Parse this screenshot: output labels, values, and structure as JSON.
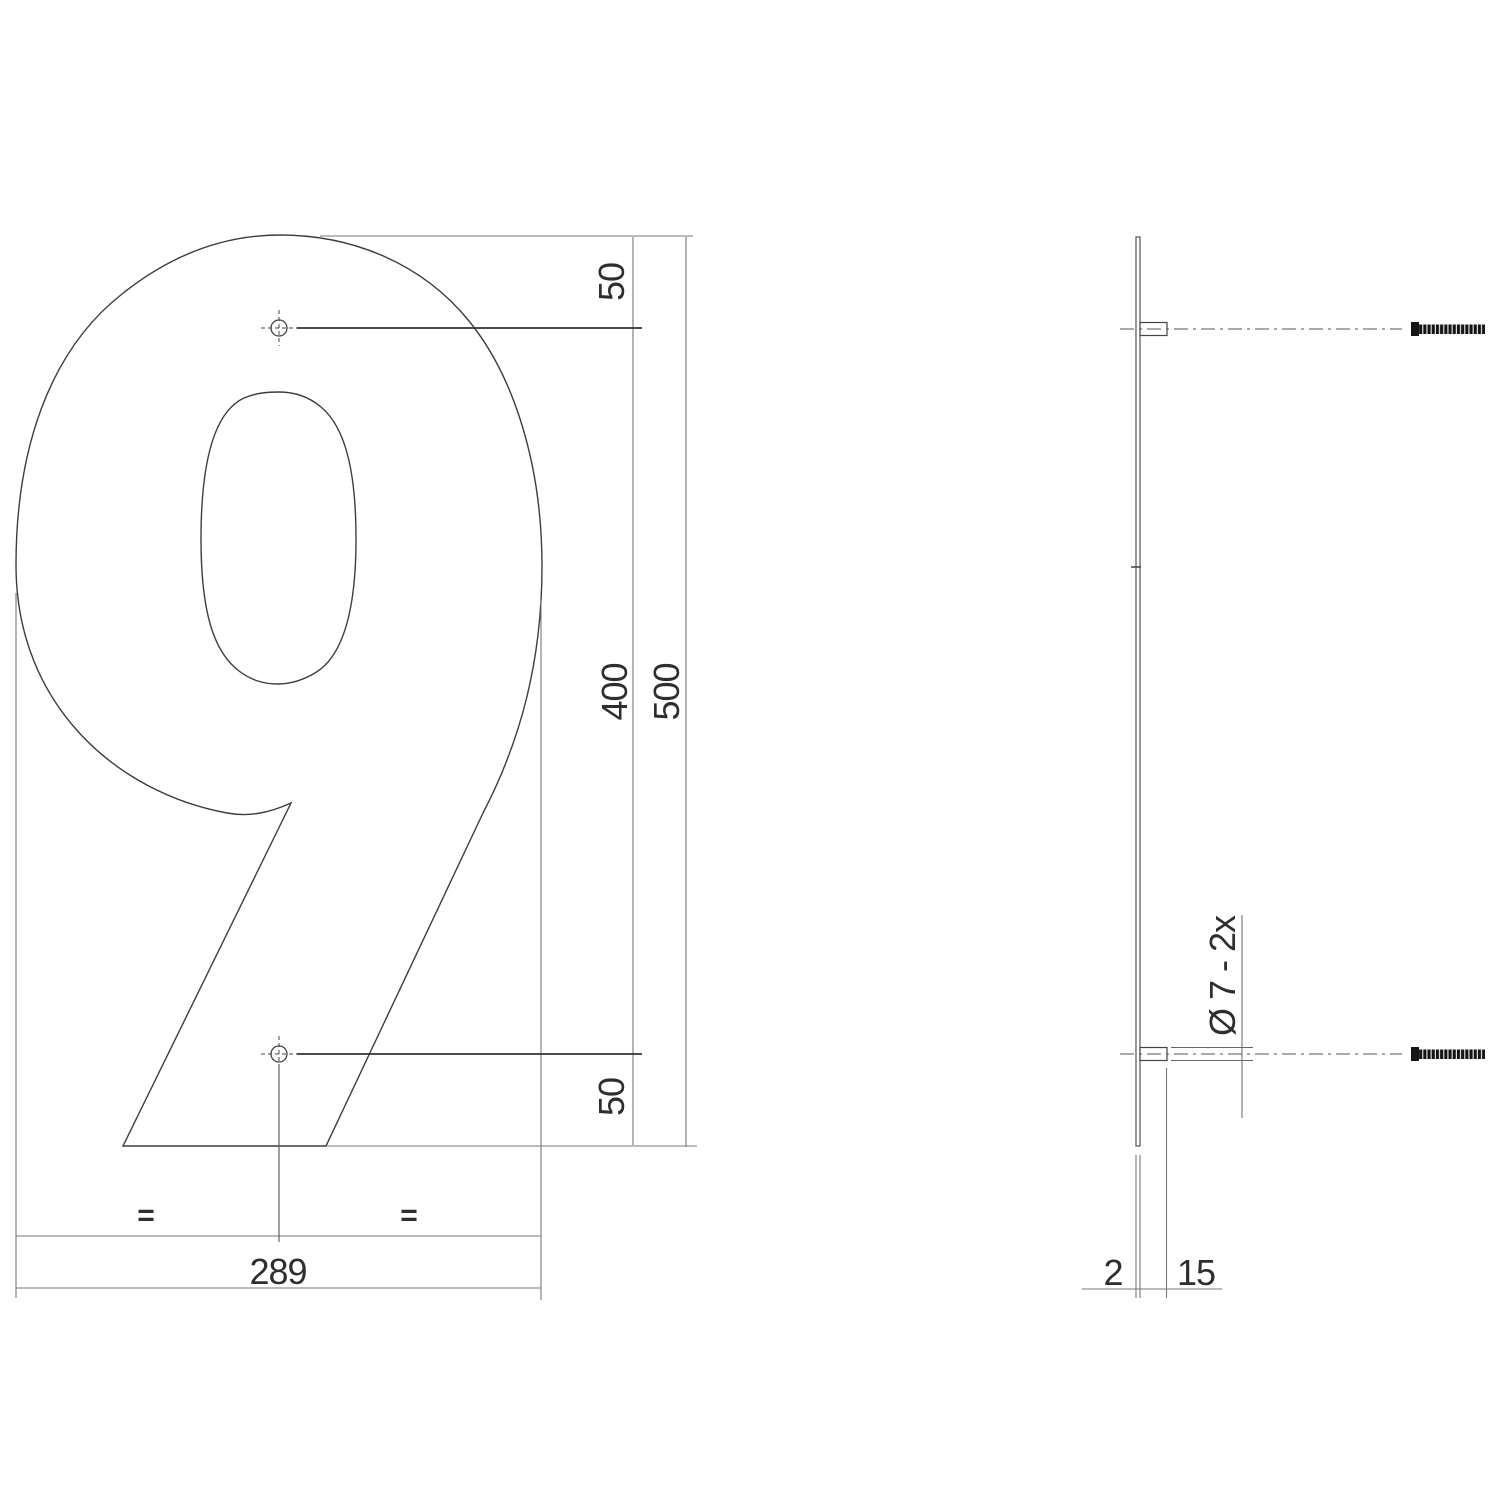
{
  "drawing": {
    "subject": "Technical dimension drawing of house number 9 (front view and side view)",
    "glyph": "9",
    "front_view": {
      "dim_top_hole_offset": "50",
      "dim_hole_spacing": "400",
      "dim_total_height": "500",
      "dim_bottom_hole_offset": "50",
      "dim_width": "289",
      "equal_left": "=",
      "equal_right": "="
    },
    "side_view": {
      "dim_thickness": "2",
      "dim_stud_length": "15",
      "dim_hole_note": "Ø 7 - 2x"
    },
    "colors": {
      "outline": "#3d3d3d",
      "dimension_line": "#777777",
      "leader_line": "#333333",
      "screw": "#151515",
      "background": "#ffffff"
    }
  }
}
